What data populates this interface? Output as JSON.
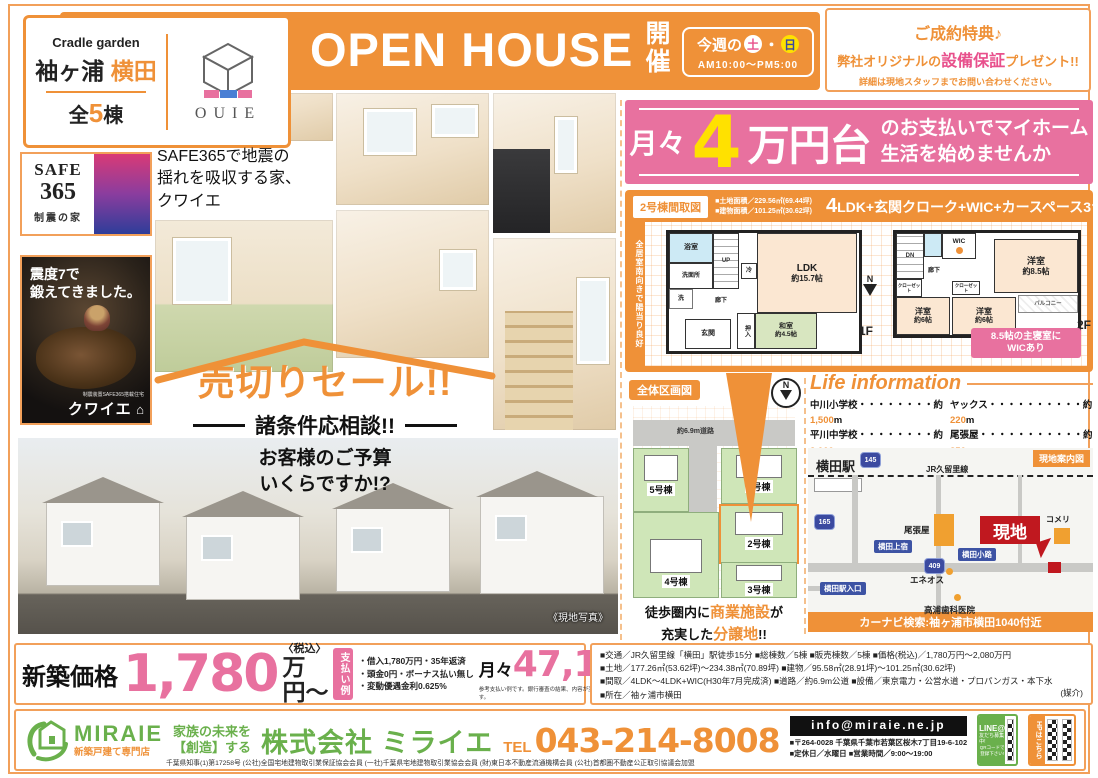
{
  "project": {
    "brand": "Cradle garden",
    "area": "袖ヶ浦",
    "name": "横田",
    "units_pre": "全",
    "units_num": "5",
    "units_suf": "棟",
    "logo": "OUIE"
  },
  "openhouse": {
    "title": "OPEN HOUSE",
    "kaisai": "開催",
    "week": "今週の",
    "sat": "土",
    "dot": "・",
    "sun": "日",
    "hours": "AM10:00〜PM5:00"
  },
  "privilege": {
    "line1": "ご成約特典♪",
    "line2a": "弊社オリジナルの",
    "line2b": "設備保証",
    "line2c": "プレゼント!!",
    "line3": "詳細は現地スタッフまでお問い合わせください。"
  },
  "safe365": {
    "l1": "SAFE",
    "l2": "365",
    "l3": "制震の家",
    "copy1": "SAFE365で地震の",
    "copy2": "揺れを吸収する家、",
    "copy3": "クワイエ"
  },
  "poster": {
    "head1": "震度7で",
    "head2": "鍛えてきました。",
    "small": "制震装置SAFE365搭載住宅",
    "brand": "クワイエ",
    "house": "⌂"
  },
  "sale": {
    "headline": "売切りセール!!",
    "sub": "諸条件応相談!!",
    "q1": "お客様のご予算",
    "q2": "いくらですか!?"
  },
  "photo_caption": "《現地写真》",
  "promo": {
    "pre": "月々",
    "num": "4",
    "unit": "万円台",
    "copy1": "のお支払いでマイホーム",
    "copy2": "生活を始めませんか"
  },
  "plan": {
    "tag": "2号棟間取図",
    "land": "■土地面積／229.56㎡(69.44坪)",
    "bldg": "■建物面積／101.25㎡(30.62坪)",
    "ldk_num": "4",
    "layout": "LDK+玄関クローク+WIC+カースペース3台",
    "side": "全居室南向きで陽当り良好",
    "f1": {
      "bath": "浴室",
      "wash": "洗面所",
      "sen": "洗",
      "fridge": "冷",
      "up": "UP",
      "ldk": "LDK",
      "ldk_size": "約15.7帖",
      "hall": "廊下",
      "oshiire": "押入",
      "washitsu": "和室",
      "washitsu_size": "約4.5帖",
      "genkan": "玄関",
      "label": "1F",
      "north": "N"
    },
    "f2": {
      "dn": "DN",
      "wic": "WIC",
      "hall": "廊下",
      "cl1": "クローゼット",
      "cl2": "クローゼット",
      "r85": "洋室",
      "r85s": "約8.5帖",
      "r6a": "洋室",
      "r6as": "約6帖",
      "r6b": "洋室",
      "r6bs": "約6帖",
      "balcony": "バルコニー",
      "label": "2F"
    },
    "badge1": "8.5帖の主寝室に",
    "badge2": "WICあり"
  },
  "siteplan": {
    "tag": "全体区画図",
    "north": "N",
    "road": "約6.9m道路",
    "lots": [
      "1号棟",
      "2号棟",
      "3号棟",
      "4号棟",
      "5号棟"
    ],
    "copy1a": "徒歩圏内に",
    "copy1b": "商業施設",
    "copy1c": "が",
    "copy2a": "充実した",
    "copy2b": "分譲地",
    "copy2c": "!!"
  },
  "life": {
    "title": "Life information",
    "items": [
      {
        "pre": "中川小学校",
        "dots": "・・・・・・・・約",
        "val": "1,500",
        "unit": "m"
      },
      {
        "pre": "ヤックス",
        "dots": "・・・・・・・・・・約",
        "val": "220",
        "unit": "m"
      },
      {
        "pre": "平川中学校",
        "dots": "・・・・・・・・約",
        "val": "2,000",
        "unit": "m"
      },
      {
        "pre": "尾張屋",
        "dots": "・・・・・・・・・・・約",
        "val": "350",
        "unit": "m"
      },
      {
        "pre": "コメリ",
        "dots": "・・・・・・・・・・・・・約",
        "val": "15",
        "unit": "m"
      },
      {
        "pre": "セブンイレブン",
        "dots": "・・・・・約",
        "val": "450",
        "unit": "m"
      }
    ]
  },
  "map": {
    "badge": "現地案内図",
    "station": "横田駅",
    "rail": "JR久留里線",
    "r145": "145",
    "r165": "165",
    "r409": "409",
    "owariya": "尾張屋",
    "komeri": "コメリ",
    "genchi": "現地",
    "kamijuku": "横田上宿",
    "koji": "横田小路",
    "ekiiriguchi": "横田駅入口",
    "eneos": "エネオス",
    "dental": "高浦歯科医院",
    "navi": "カーナビ検索:袖ヶ浦市横田1040付近"
  },
  "specs": {
    "l1": "■交通／JR久留里線「横田」駅徒歩15分 ■総棟数／5棟 ■販売棟数／5棟 ■価格(税込)／1,780万円〜2,080万円",
    "l2": "■土地／177.26㎡(53.62坪)〜234.38㎡(70.89坪) ■建物／95.58㎡(28.91坪)〜101.25㎡(30.62坪)",
    "l3": "■間取／4LDK〜4LDK+WIC(H30年7月完成済) ■道路／約6.9m公道 ■設備／東京電力・公営水道・プロパンガス・本下水",
    "l4": "■所在／袖ヶ浦市横田",
    "mediation": "(媒介)"
  },
  "price": {
    "label": "新築価格",
    "amount": "1,780",
    "tax": "〈税込〉",
    "unit": "万円〜",
    "ex_label": "支払い例",
    "b1": "・借入1,780万円・35年返済",
    "b2": "・頭金0円・ボーナス払い無し",
    "b3": "・変動優遇金利0.625%",
    "m_pre": "月々",
    "m_val": "47,196",
    "m_unit": "円",
    "note": "参考支払い例です。銀行審査の結果、内容が変更になる場合がございます。"
  },
  "footer": {
    "logo": "MIRAIE",
    "logo_sub": "新築戸建て専門店",
    "tag1": "家族の未来を",
    "tag2": "【創造】する",
    "company": "株式会社 ミライエ",
    "tel_label": "TEL",
    "tel": "043-214-8008",
    "email": "info@miraie.ne.jp",
    "address": "■〒264-0028 千葉県千葉市若葉区桜木7丁目19-6-102",
    "hours": "■定休日／水曜日 ■営業時間／9:00〜19:00",
    "license": "千葉県知事(1)第17258号 (公社)全国宅地建物取引業保証協会会員 (一社)千葉県宅地建物取引業協会会員 (財)東日本不動産流通機構会員 (公社)首都圏不動産公正取引協議会加盟",
    "line1": "LINE@",
    "line2": "友だち募集中!",
    "line3": "QRコードで",
    "line4": "登録下さい!",
    "hp": "HPはこちら"
  }
}
